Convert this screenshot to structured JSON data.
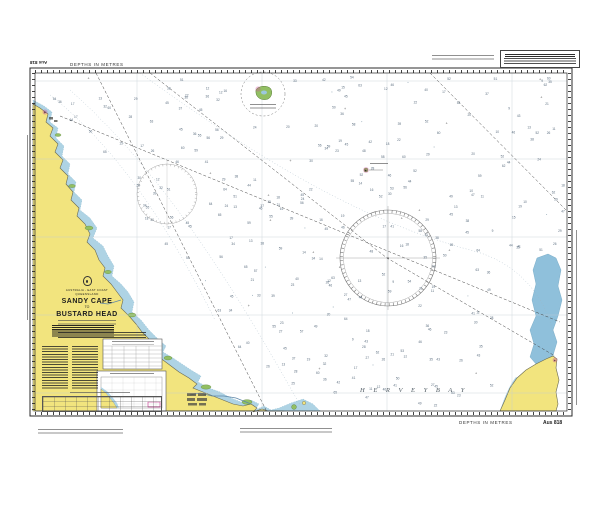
{
  "chart": {
    "number": "Aus 818",
    "number_top": "Aus 818",
    "depths_top": "DEPTHS IN METRES",
    "depths_bottom": "DEPTHS IN METRES",
    "title_block": {
      "region": "AUSTRALIA - EAST COAST",
      "state": "QUEENSLAND",
      "line1": "SANDY CAPE",
      "line2": "TO",
      "line3": "BUSTARD HEAD"
    },
    "sea_labels": {
      "hervey_bay": "H E R V E Y   B A Y"
    },
    "symbols": {
      "light_star": "✶"
    },
    "colors": {
      "land": "#f2e47e",
      "shallow": "#aed3e4",
      "spit": "#8fc0db",
      "reef": "#92bf63",
      "magenta": "#cf4f9e",
      "frame": "#2b2b2b",
      "grid": "#c2ccd4",
      "sounding": "#41566b"
    }
  },
  "decor": {
    "soundings": {
      "count": 430,
      "seed": 13,
      "min": 9,
      "max": 66
    }
  }
}
